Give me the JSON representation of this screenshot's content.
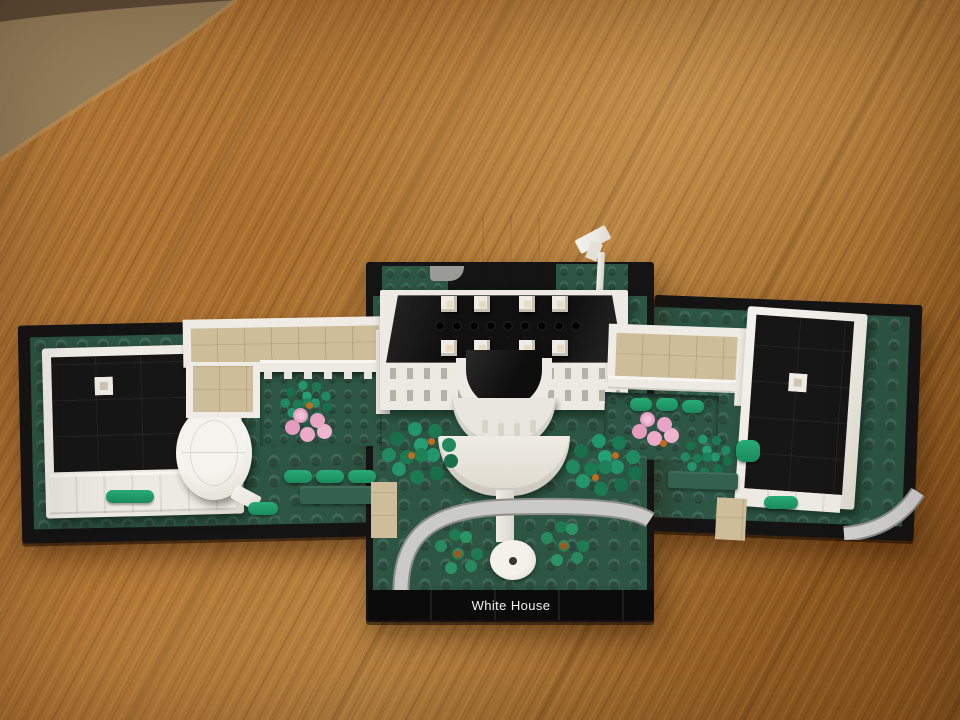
{
  "scene": {
    "description": "Photograph of a LEGO Architecture White House model displayed on a wooden table",
    "nameplate": {
      "label": "White House"
    }
  },
  "colors": {
    "table_wood": "#a9702f",
    "floor": "#97815c",
    "plate_edge_black": "#141414",
    "lawn_green": "#2c5543",
    "hedge_green": "#27ac77",
    "tree_green": "#1d8158",
    "branch_orange": "#bd6d1e",
    "rose_pink": "#e8a4c4",
    "courtyard_tan": "#cdbd98",
    "building_white": "#efece5",
    "roof_black": "#161616",
    "driveway_gray": "#c9c9c7",
    "nameplate_text": "#f4f4f2"
  }
}
